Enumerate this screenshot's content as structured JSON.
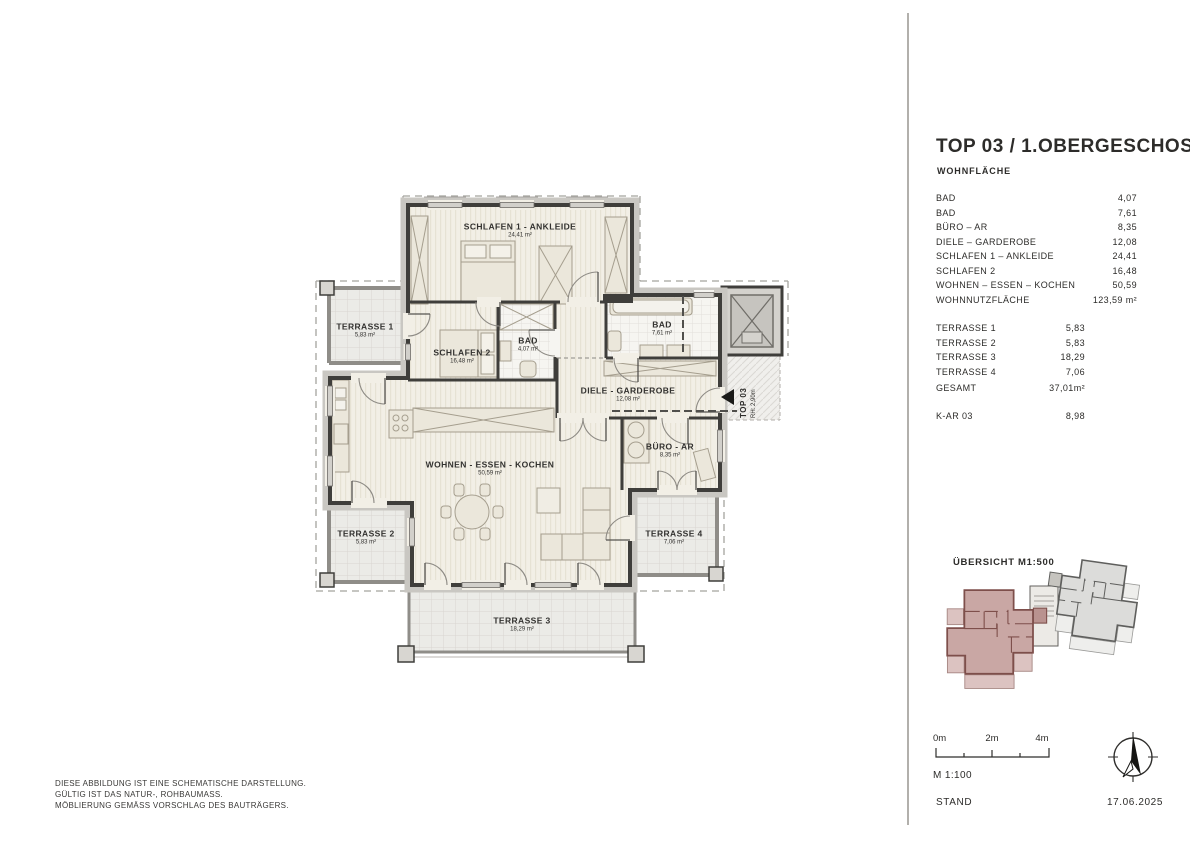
{
  "page": {
    "background": "#ffffff",
    "wall_color": "#3f3e3b",
    "accent_pink": "#c9a7a4"
  },
  "panel": {
    "title": "TOP 03 / 1.OBERGESCHOSS",
    "section_label": "WOHNFLÄCHE",
    "rooms": [
      {
        "label": "BAD",
        "value": "4,07"
      },
      {
        "label": "BAD",
        "value": "7,61"
      },
      {
        "label": "BÜRO – AR",
        "value": "8,35"
      },
      {
        "label": "DIELE – GARDEROBE",
        "value": "12,08"
      },
      {
        "label": "SCHLAFEN 1 – ANKLEIDE",
        "value": "24,41"
      },
      {
        "label": "SCHLAFEN 2",
        "value": "16,48"
      },
      {
        "label": "WOHNEN – ESSEN – KOCHEN",
        "value": "50,59"
      }
    ],
    "total": {
      "label": "WOHNNUTZFLÄCHE",
      "value": "123,59 m²"
    },
    "terraces": [
      {
        "label": "TERRASSE 1",
        "value": "5,83"
      },
      {
        "label": "TERRASSE 2",
        "value": "5,83"
      },
      {
        "label": "TERRASSE 3",
        "value": "18,29"
      },
      {
        "label": "TERRASSE 4",
        "value": "7,06"
      }
    ],
    "terrace_total": {
      "label": "GESAMT",
      "value": "37,01m²"
    },
    "storage": {
      "label": "K-AR 03",
      "value": "8,98"
    },
    "overview_label": "ÜBERSICHT M1:500",
    "scalebar": {
      "tick0": "0m",
      "tick1": "2m",
      "tick2": "4m",
      "scale": "M 1:100"
    },
    "stand_label": "STAND",
    "stand_date": "17.06.2025"
  },
  "plan": {
    "rooms": [
      {
        "name": "SCHLAFEN 1 - ANKLEIDE",
        "area": "24,41 m²"
      },
      {
        "name": "SCHLAFEN 2",
        "area": "16,48 m²"
      },
      {
        "name": "BAD",
        "area": "4,07 m²"
      },
      {
        "name": "BAD",
        "area": "7,61 m²"
      },
      {
        "name": "DIELE - GARDEROBE",
        "area": "12,08 m²"
      },
      {
        "name": "BÜRO - AR",
        "area": "8,35 m²"
      },
      {
        "name": "WOHNEN - ESSEN - KOCHEN",
        "area": "50,59 m²"
      },
      {
        "name": "TERRASSE 1",
        "area": "5,83 m²"
      },
      {
        "name": "TERRASSE 2",
        "area": "5,83 m²"
      },
      {
        "name": "TERRASSE 3",
        "area": "18,29 m²"
      },
      {
        "name": "TERRASSE 4",
        "area": "7,06 m²"
      }
    ],
    "entrance": {
      "label": "TOP 03",
      "height": "RH: 2,90m"
    }
  },
  "footer": {
    "line1": "DIESE ABBILDUNG IST EINE SCHEMATISCHE DARSTELLUNG.",
    "line2": "GÜLTIG IST DAS NATUR-, ROHBAUMASS.",
    "line3": "MÖBLIERUNG GEMÄSS VORSCHLAG DES BAUTRÄGERS."
  }
}
